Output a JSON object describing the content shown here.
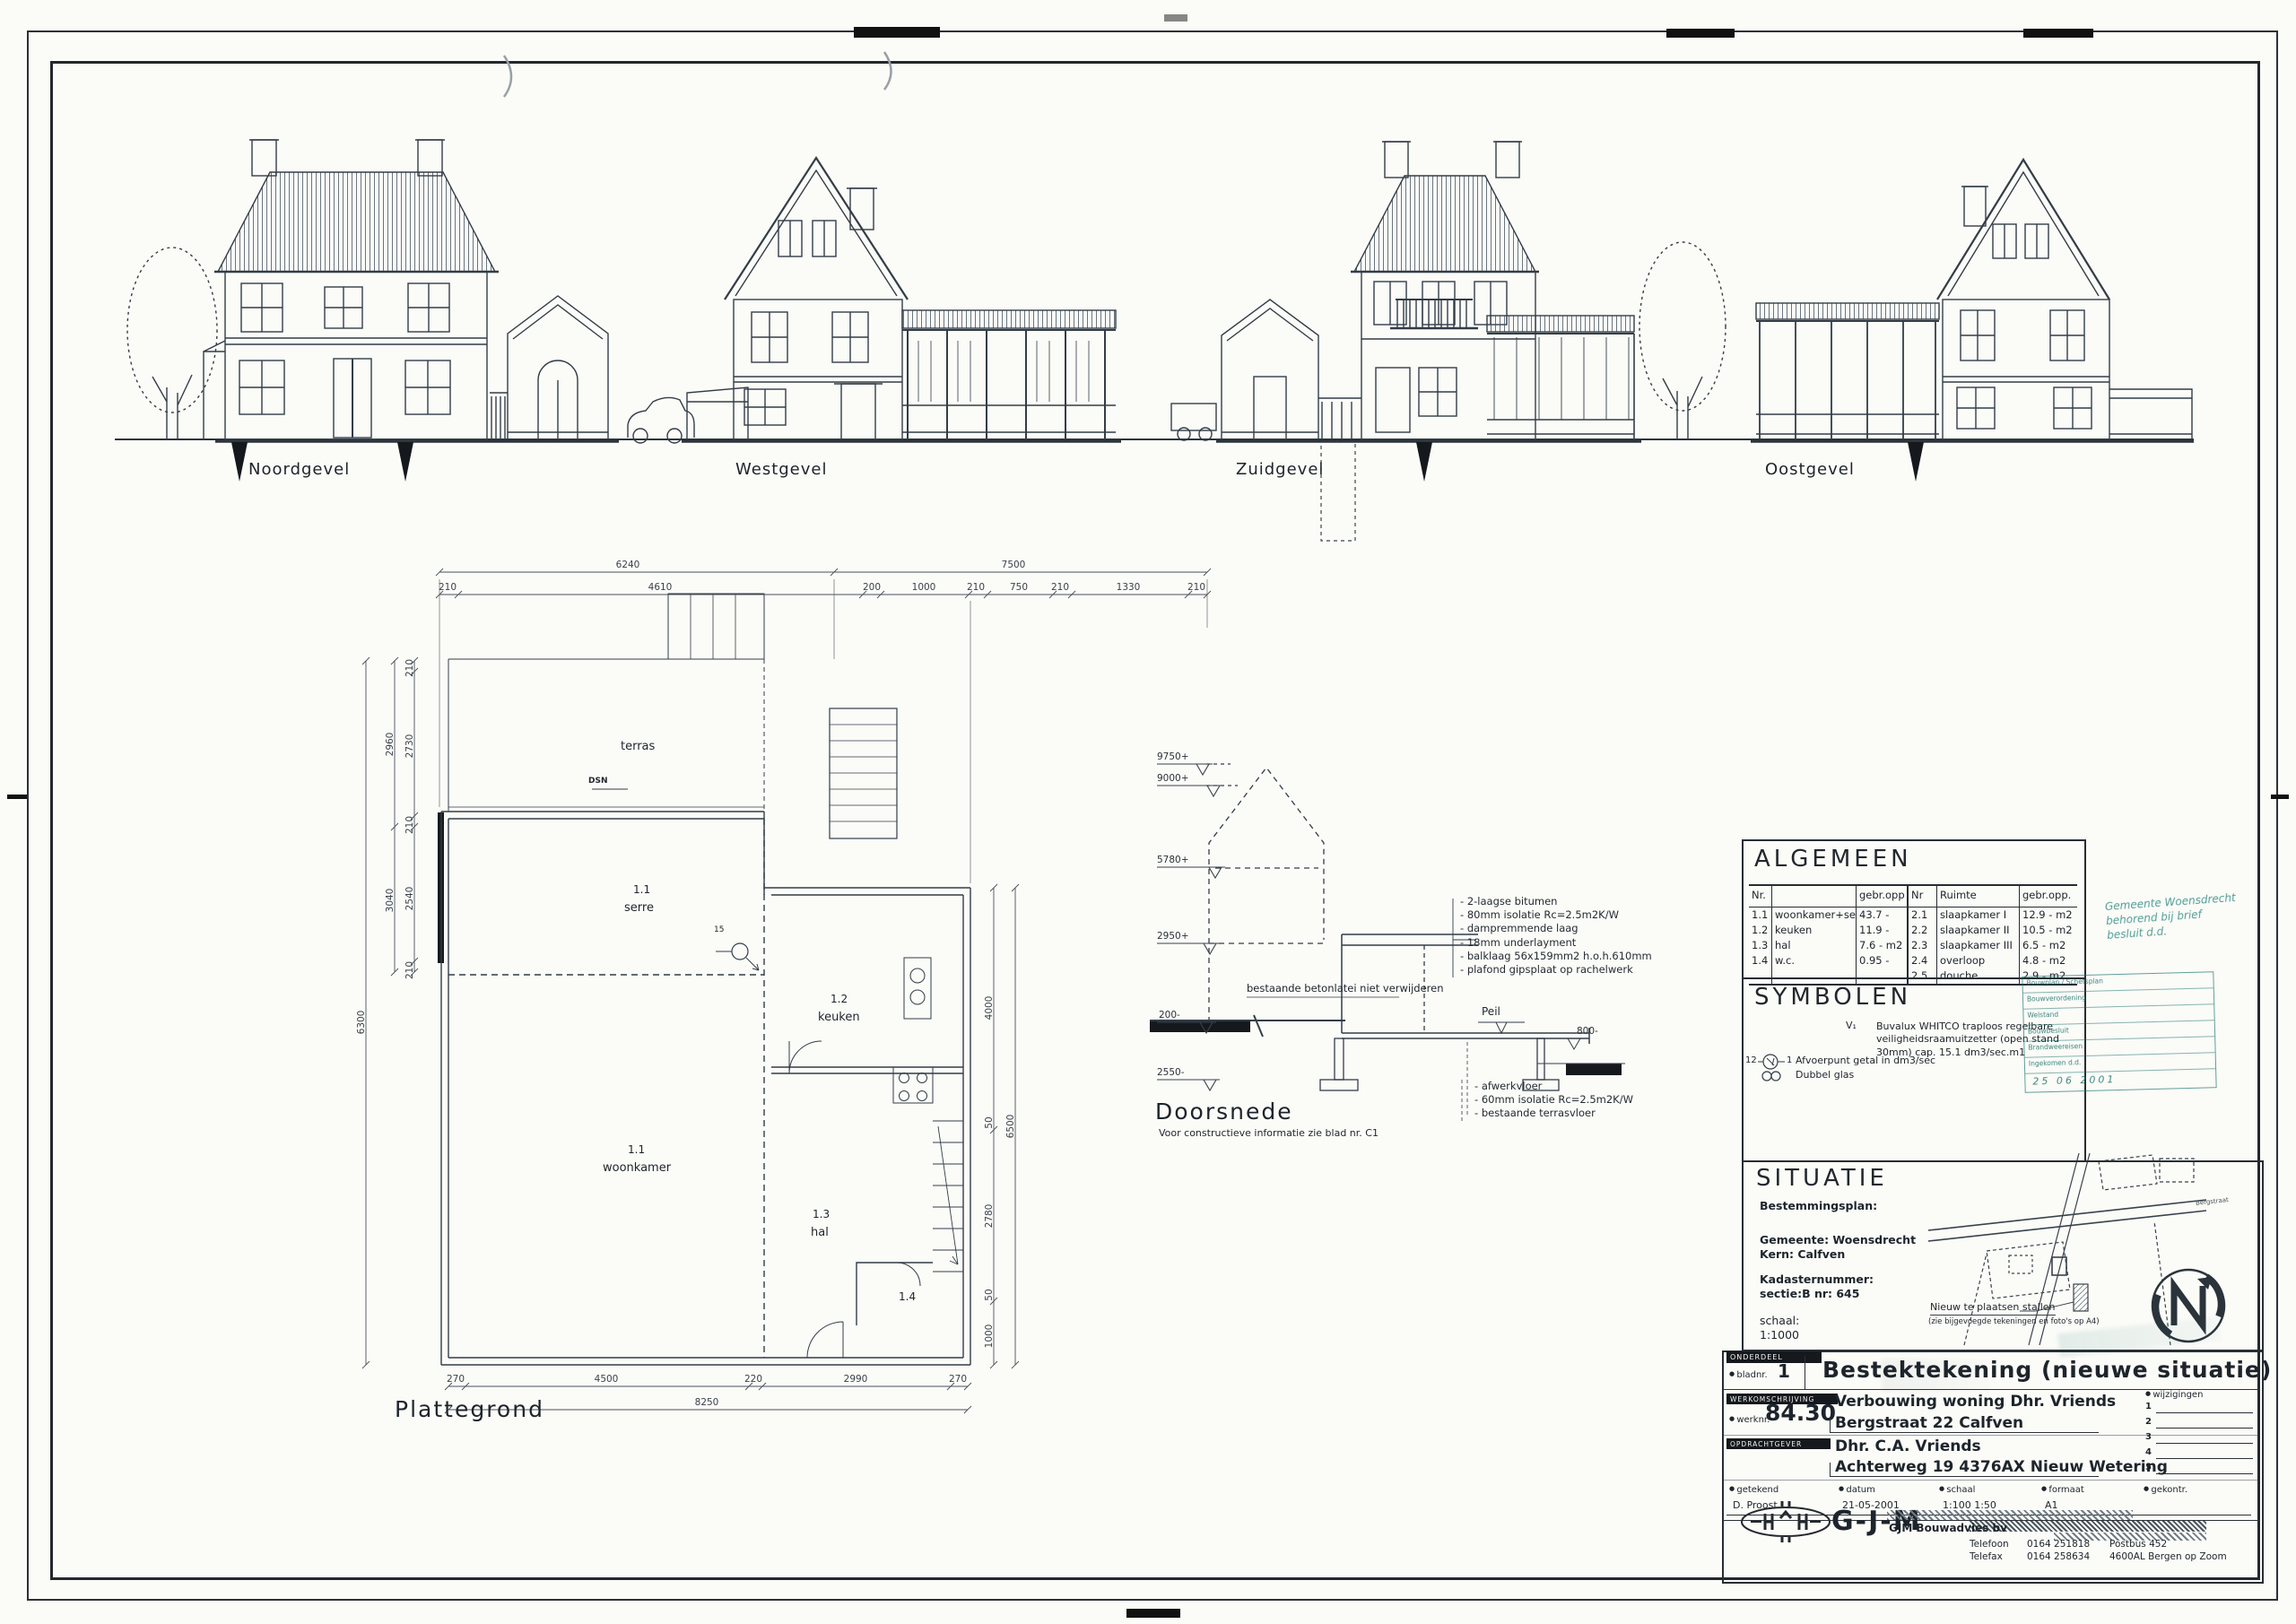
{
  "sheet": {
    "elevation_labels": [
      "Noordgevel",
      "Westgevel",
      "Zuidgevel",
      "Oostgevel"
    ],
    "plattegrond": {
      "title": "Plattegrond",
      "terras": "terras",
      "dsn": "DSN",
      "afvoer": "15",
      "rooms": {
        "serre_nr": "1.1",
        "serre_name": "serre",
        "woonkamer_nr": "1.1",
        "woonkamer_name": "woonkamer",
        "keuken_nr": "1.2",
        "keuken_name": "keuken",
        "hal_nr": "1.3",
        "hal_name": "hal",
        "wc_nr": "1.4"
      },
      "dims": {
        "top_outer": [
          "6240",
          "7500"
        ],
        "top_inner": [
          "210",
          "4610",
          "200",
          "1000",
          "210",
          "750",
          "210",
          "1330",
          "210"
        ],
        "left_outer": [
          "2960",
          "3040"
        ],
        "left_inner": [
          "210",
          "2730",
          "210",
          "2540",
          "210"
        ],
        "far_left": "6300",
        "right_inner": [
          "4000",
          "50",
          "2780",
          "50",
          "1000"
        ],
        "right_outer": "6500",
        "bottom_inner": [
          "270",
          "4500",
          "220",
          "2990",
          "270"
        ],
        "bottom_outer": "8250"
      }
    },
    "doorsnede": {
      "title": "Doorsnede",
      "subtitle": "Voor constructieve informatie zie blad nr. C1",
      "levels": [
        "9750+",
        "9000+",
        "5780+",
        "2950+",
        "200-",
        "2550-"
      ],
      "level_right": "800-",
      "peil": "Peil",
      "note_mid": "bestaande betonlatei niet verwijderen",
      "roof_notes": [
        "2-laagse bitumen",
        "80mm isolatie Rc=2.5m2K/W",
        "dampremmende laag",
        "18mm underlayment",
        "balklaag 56x159mm2 h.o.h.610mm",
        "plafond gipsplaat op rachelwerk"
      ],
      "floor_notes": [
        "afwerkvloer",
        "60mm isolatie Rc=2.5m2K/W",
        "bestaande terrasvloer"
      ]
    }
  },
  "titleblock": {
    "algemeen": {
      "title": "ALGEMEEN",
      "headers": {
        "nr": "Nr.",
        "opp": "gebr.opp",
        "nr2": "Nr",
        "ruimte": "Ruimte",
        "opp2": "gebr.opp."
      },
      "left_rows": [
        {
          "nr": "1.1",
          "name": "woonkamer+serre",
          "opp": "43.7 - m2"
        },
        {
          "nr": "1.2",
          "name": "keuken",
          "opp": "11.9 - m2"
        },
        {
          "nr": "1.3",
          "name": "hal",
          "opp": "7.6 - m2"
        },
        {
          "nr": "1.4",
          "name": "w.c.",
          "opp": "0.95 - m2"
        }
      ],
      "right_rows": [
        {
          "nr": "2.1",
          "name": "slaapkamer I",
          "opp": "12.9 - m2"
        },
        {
          "nr": "2.2",
          "name": "slaapkamer II",
          "opp": "10.5 - m2"
        },
        {
          "nr": "2.3",
          "name": "slaapkamer III",
          "opp": "6.5 - m2"
        },
        {
          "nr": "2.4",
          "name": "overloop",
          "opp": "4.8 - m2"
        },
        {
          "nr": "2.5",
          "name": "douche",
          "opp": "2.9 - m2"
        }
      ]
    },
    "symbolen": {
      "title": "SYMBOLEN",
      "v_sym": "V₁",
      "v_text": "Buvalux WHITCO traploos regelbare veiligheidsraamuitzetter (open stand 30mm) cap. 15.1 dm3/sec.m1",
      "afvoer_pre": "12",
      "afvoer_post": "1",
      "afvoer_text": "Afvoerpunt getal in dm3/sec",
      "glas_text": "Dubbel glas"
    },
    "situatie": {
      "title": "SITUATIE",
      "bestemmingsplan": "Bestemmingsplan:",
      "gemeente": "Gemeente: Woensdrecht",
      "kern": "Kern: Calfven",
      "kadaster_label": "Kadasternummer:",
      "kadaster_value": "sectie:B    nr: 645",
      "schaal_label": "schaal:",
      "schaal_value": "1:1000",
      "note1": "Nieuw te plaatsen stallen",
      "note2": "(zie bijgevoegde tekeningen en foto's op A4)",
      "road": "Bergstraat"
    },
    "stamps": {
      "s1_lines": [
        "Gemeente Woensdrecht",
        "behorend bij brief",
        "besluit d.d."
      ],
      "s2_rows": [
        "Bouwplan / Schetsplan",
        "Bouwverordening",
        "Welstand",
        "Bouwbesluit",
        "Brandweereisen",
        "Ingekomen d.d."
      ],
      "s2_date": "25 06 2001"
    },
    "onderdeel_label": "ONDERDEEL",
    "bladnr_label": "bladnr.",
    "bladnr_value": "1",
    "main_title": "Bestektekening   (nieuwe situatie)",
    "werkomschrijving_label": "WERKOMSCHRIJVING",
    "werknr_label": "werknr.",
    "werknr_value": "84.30",
    "werk_line1": "Verbouwing woning Dhr. Vriends",
    "werk_line2": "Bergstraat 22   Calfven",
    "opdrachtgever_label": "OPDRACHTGEVER",
    "opdr_line1": "Dhr. C.A. Vriends",
    "opdr_line2": "Achterweg 19     4376AX     Nieuw Wetering",
    "wijz_label": "wijzigingen",
    "wijz_nrs": [
      "1",
      "2",
      "3",
      "4",
      "5"
    ],
    "fields": {
      "getekend_label": "getekend",
      "getekend_value": "D. Proost",
      "datum_label": "datum",
      "datum_value": "21-05-2001",
      "schaal_label": "schaal",
      "schaal_value": "1:100   1:50",
      "formaat_label": "formaat",
      "formaat_value": "A1",
      "gekontr_label": "gekontr."
    },
    "logo_text": "G-J-M",
    "company": "GJM Bouwadvies bv",
    "contact": {
      "tel_label": "Telefoon",
      "tel": "0164  251818",
      "fax_label": "Telefax",
      "fax": "0164  258634",
      "postbus": "Postbus 452",
      "city": "4600AL  Bergen op Zoom"
    }
  }
}
